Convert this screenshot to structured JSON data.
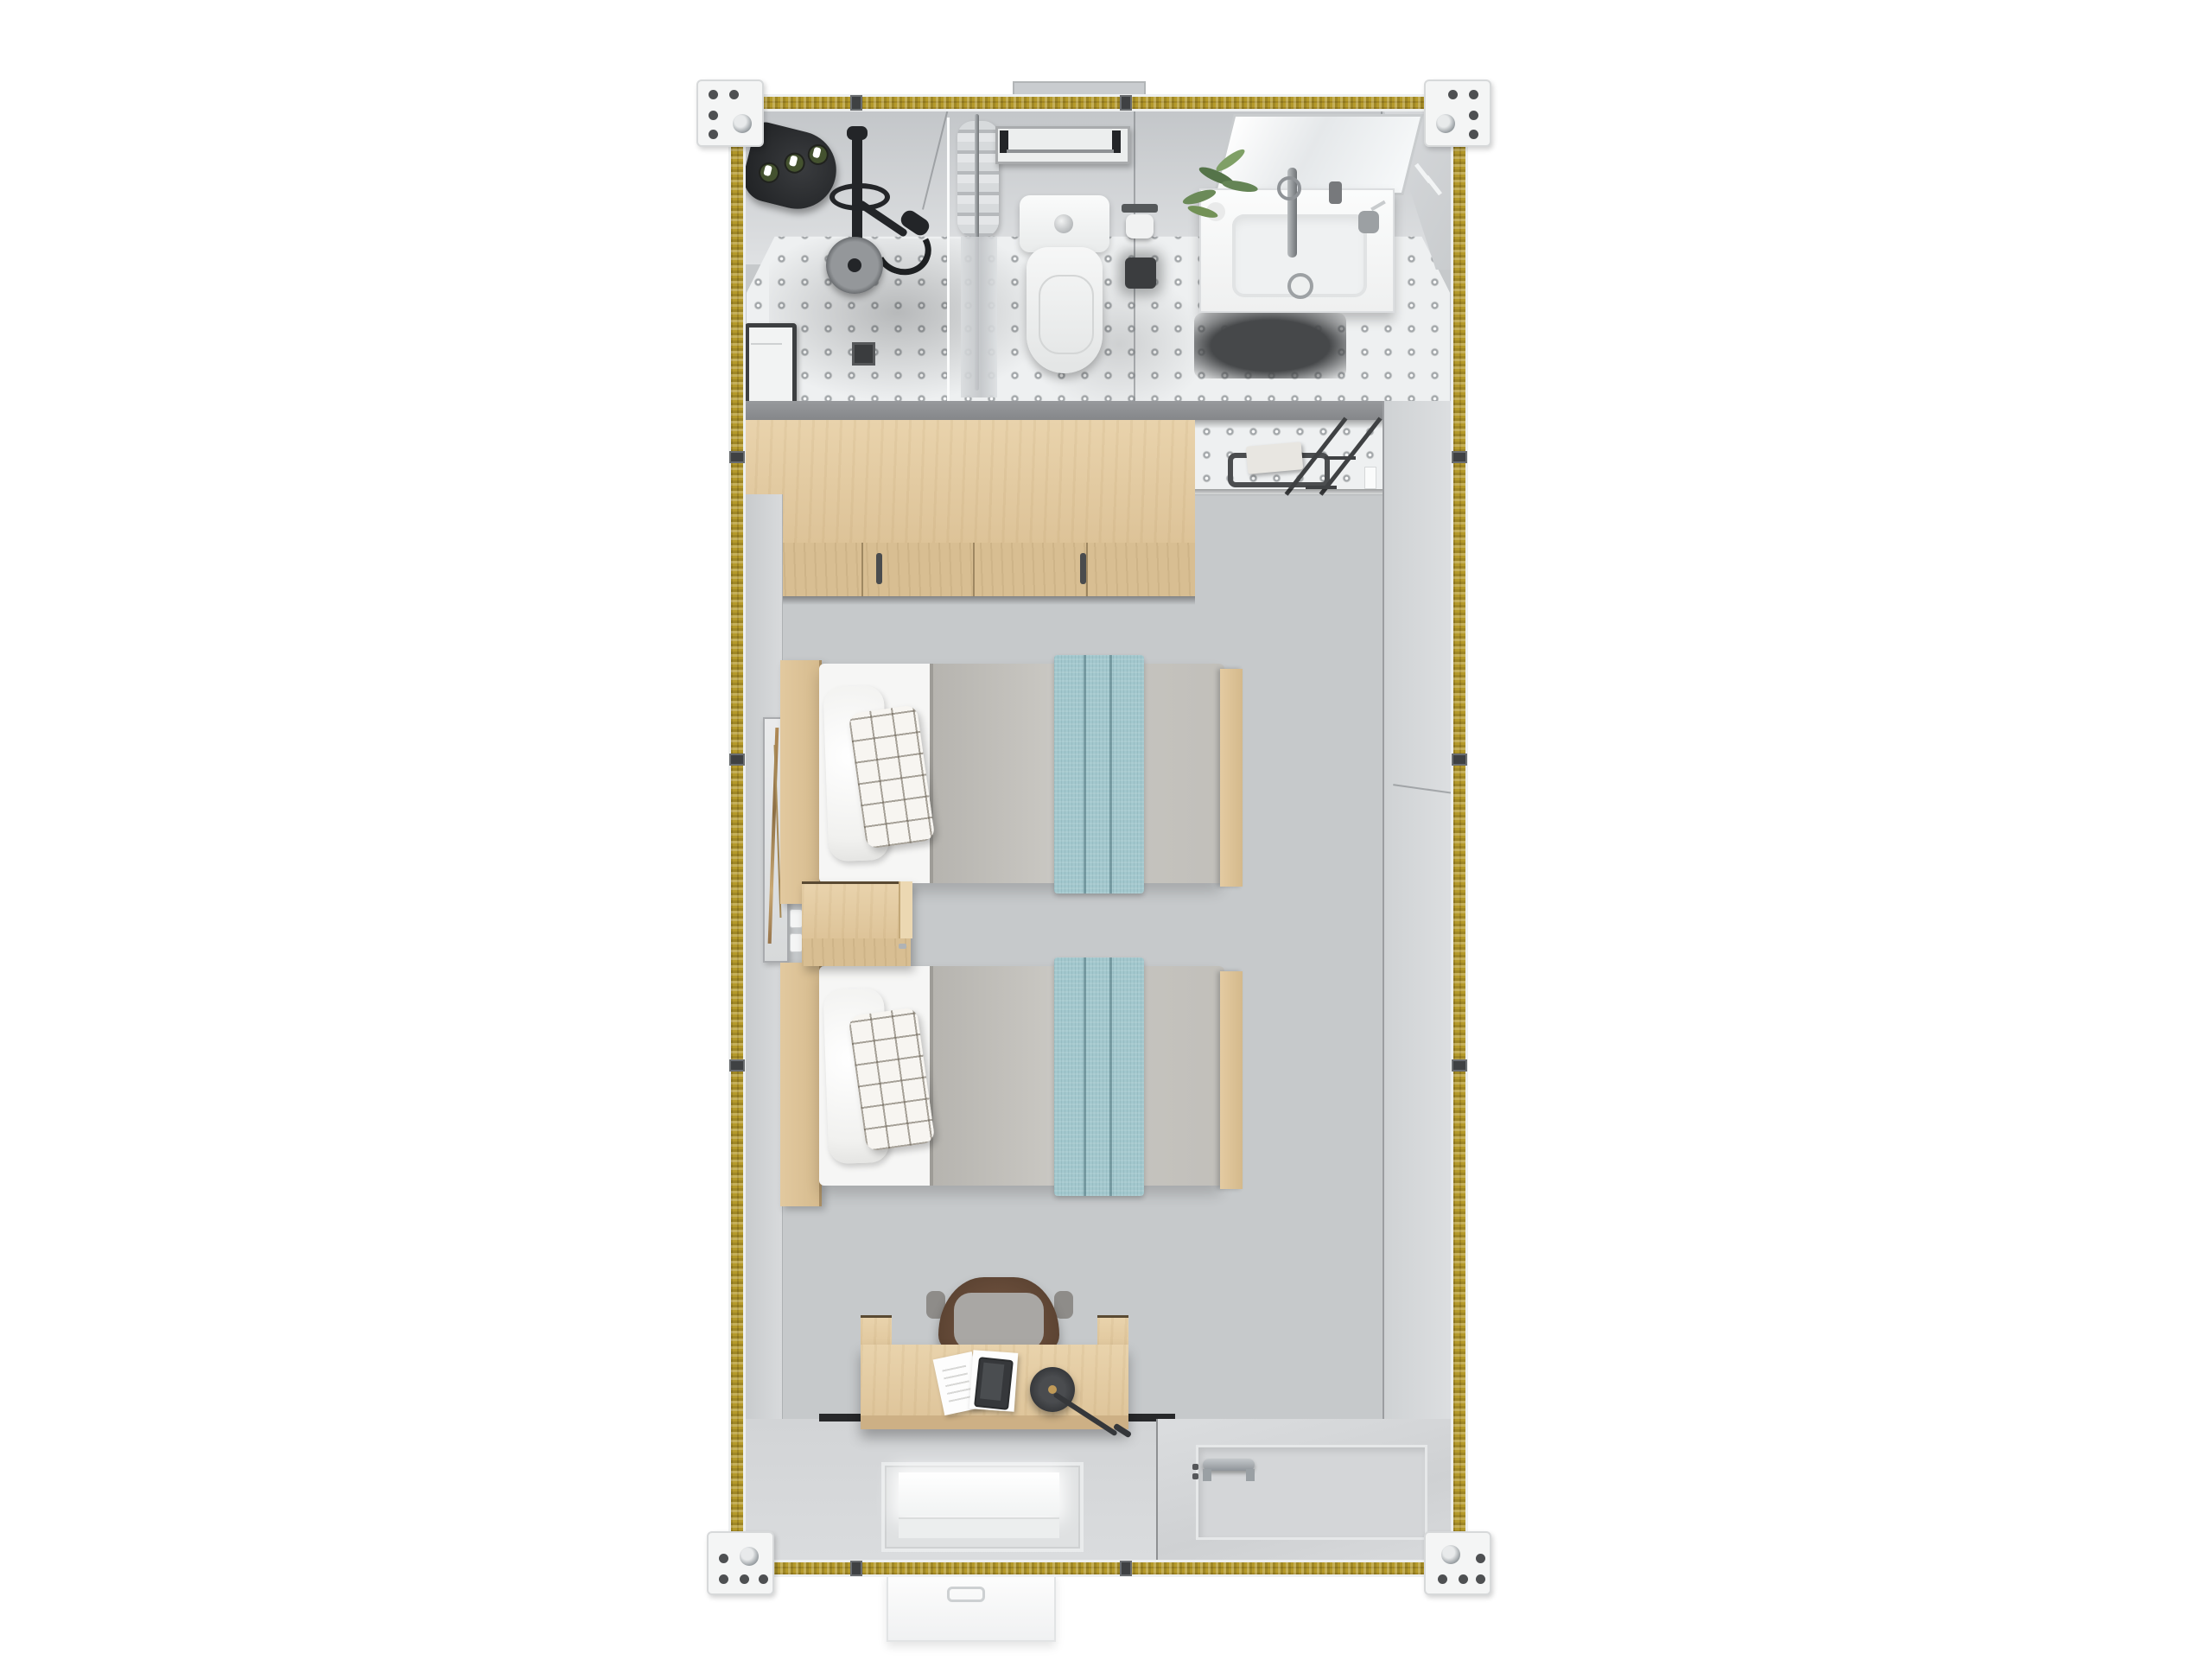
{
  "scene": {
    "type": "3d-top-down-floor-plan-render",
    "description": "Top-down 3D render of a modular container guest unit with ensuite bathroom, wardrobe, twin-bed room, desk and entry door",
    "background_color": "#ffffff",
    "no_visible_text": true
  },
  "colors": {
    "frame_insulation_yellow": "#b59a2b",
    "corner_casting_white": "#f4f5f5",
    "partition_wall_gray": "#8d8f92",
    "interior_wall_gray": "#d3d6d8",
    "bedroom_floor_gray": "#c6c9cb",
    "bathroom_tile_white": "#eef0f1",
    "tile_dot_gray": "#a2a6a9",
    "wood_light": "#e5cfa6",
    "wood_front": "#d8be92",
    "duvet_gray": "#c1bfba",
    "sheet_white": "#f6f6f5",
    "blanket_teal": "#a2c7cd",
    "chair_brown": "#6e5140",
    "fixture_black": "#232528",
    "chrome_gray": "#9aa0a4",
    "plant_green": "#6b8a58"
  },
  "frame": {
    "corner_castings": 4,
    "top_panel_joints_x": [
      990,
      1300
    ],
    "bottom_panel_joints_x": [
      990,
      1300
    ],
    "side_panel_joints_y": [
      528,
      878,
      1232
    ],
    "exterior_top_ledge": 1,
    "exterior_entry_step": 1
  },
  "titles": {
    "unit": "container unit floor plan",
    "bathroom": "bathroom",
    "shower_shelf": "corner shower shelf with 3 bottles",
    "shower_set": "black shower mixer set",
    "rain_head": "round rain shower head",
    "basket": "shower storage basket",
    "drain": "floor drain",
    "curtain": "shower curtain on rod",
    "towel_rack": "wall towel rack",
    "toilet": "toilet",
    "tp_holder": "toilet paper holder",
    "brush": "toilet brush",
    "mirror": "wall mirror",
    "vanity": "sink vanity",
    "plant": "potted plant",
    "vanity_mat": "dark bath mat",
    "partition": "bathroom partition wall",
    "wardrobe": "three-door wardrobe",
    "entry_towel_bar": "towel bar with towel",
    "glass_door": "glass bathroom door",
    "art": "wall art frame",
    "outlet": "wall outlet strip",
    "bed1": "twin bed 1",
    "bed2": "twin bed 2",
    "nightstand": "nightstand",
    "chair": "desk chair",
    "desk": "writing desk",
    "papers": "open notebook",
    "tablet": "tablet",
    "lamp": "desk lamp",
    "window": "front wall window",
    "door": "entry door with handle",
    "step": "exterior entry step"
  },
  "inventory": {
    "bathroom": [
      "corner shelf with 3 bottles",
      "black shower set",
      "rain shower head",
      "storage basket",
      "floor drain",
      "shower curtain",
      "towel rack",
      "toilet with flush button",
      "toilet paper holder",
      "toilet brush",
      "mirror",
      "vanity sink with faucet",
      "plant",
      "soap dispenser",
      "toothbrush cup",
      "dark bath mat",
      "perforated tile floor"
    ],
    "bedroom": [
      "three-door wardrobe with 2 handles",
      "towel bar with white towel",
      "glass door",
      "tall wall art frame",
      "outlet strip",
      "twin bed with plain pillow",
      "twin bed with checked pillow",
      "gray duvet x2",
      "teal runner blanket x2",
      "wood headboard x2",
      "wood footboard x2",
      "nightstand",
      "desk with side panels",
      "brown office chair",
      "notebook papers",
      "tablet",
      "black round desk lamp"
    ],
    "envelope": [
      "4 corner castings",
      "yellow insulated wall panels",
      "panel joint connectors",
      "front window",
      "entry door with chrome handle",
      "exterior step",
      "exterior top ledge"
    ]
  },
  "bed_count": 2,
  "wardrobe_door_count": 3
}
